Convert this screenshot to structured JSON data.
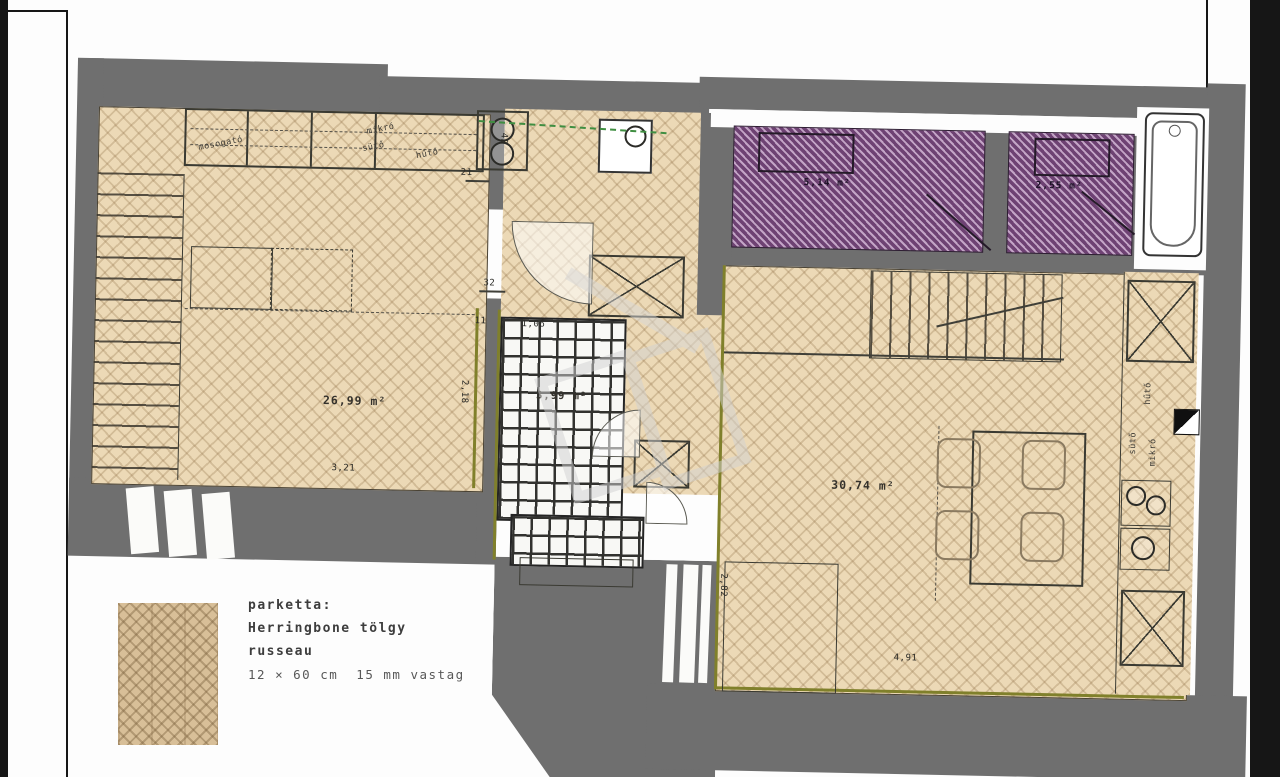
{
  "document": {
    "type": "apartment floor plan sheet",
    "flooring_theme": "herringbone parquet"
  },
  "plan": {
    "rooms": [
      {
        "id": "living-room",
        "area_label": "26,99 m²",
        "floor": "herringbone-parquet"
      },
      {
        "id": "wet-room",
        "area_label": "3,99 m²",
        "floor": "tile-grid"
      },
      {
        "id": "main-room",
        "area_label": "30,74 m²",
        "floor": "herringbone-parquet"
      },
      {
        "id": "bathroom-1",
        "area_label": "5,14 m²",
        "floor": "purple-hatch"
      },
      {
        "id": "bathroom-2",
        "area_label": "2,55 m²",
        "floor": "purple-hatch"
      }
    ],
    "dims": {
      "living_w": "3,21",
      "living_h": "2,18",
      "niche_w": "32",
      "niche_gap": "11",
      "counter_end": "21",
      "closet_depth": "42",
      "wet_w": "1,06",
      "main_w": "4,91",
      "main_left_h": "2,82"
    },
    "appliance_labels": {
      "left_kitchen": [
        "mosogató",
        "mikró",
        "sütő",
        "hűtő"
      ],
      "right_kitchen": [
        "hűtő",
        "sütő",
        "mikró"
      ]
    },
    "colors": {
      "wall": "#6f6f6f",
      "parquet": "#ecd9b6",
      "purple_hatch": "#6e4273",
      "olive_accent": "#80802b",
      "green_dashed": "#3f8e41"
    }
  },
  "legend": {
    "title": "parketta:",
    "material": "Herringbone tölgy",
    "finish": "russeau",
    "size": "12 × 60 cm  15 mm vastag",
    "swatch": "herringbone-parquet-sample"
  }
}
